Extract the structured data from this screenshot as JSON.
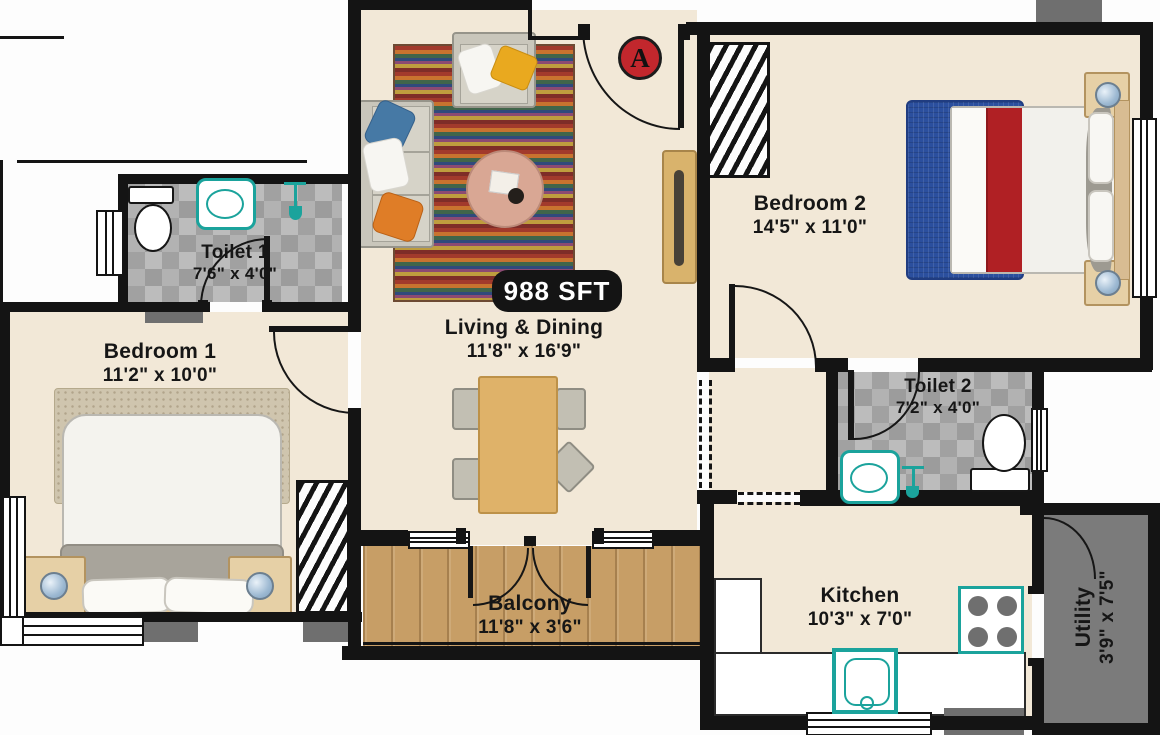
{
  "plan": {
    "area_badge": "988 SFT",
    "entrance_marker": "A",
    "rooms": {
      "living": {
        "name": "Living & Dining",
        "dims": "11'8\" x 16'9\""
      },
      "bedroom1": {
        "name": "Bedroom 1",
        "dims": "11'2\" x 10'0\""
      },
      "bedroom2": {
        "name": "Bedroom 2",
        "dims": "14'5\" x 11'0\""
      },
      "toilet1": {
        "name": "Toilet 1",
        "dims": "7'6\" x 4'0\""
      },
      "toilet2": {
        "name": "Toilet 2",
        "dims": "7'2\" x 4'0\""
      },
      "kitchen": {
        "name": "Kitchen",
        "dims": "10'3\" x 7'0\""
      },
      "balcony": {
        "name": "Balcony",
        "dims": "11'8\" x 3'6\""
      },
      "utility": {
        "name": "Utility",
        "dims": "3'9\" x 7'5\""
      }
    },
    "colors": {
      "wall": "#141414",
      "floor": "#f2e8d7",
      "tile": "#a9a9a9",
      "balcony_wood": "#c79e66",
      "utility_floor": "#7b7b7b",
      "fixture_teal": "#1ba39c",
      "marker_red": "#c2272d",
      "badge_bg": "#141414",
      "badge_text": "#ffffff"
    }
  }
}
